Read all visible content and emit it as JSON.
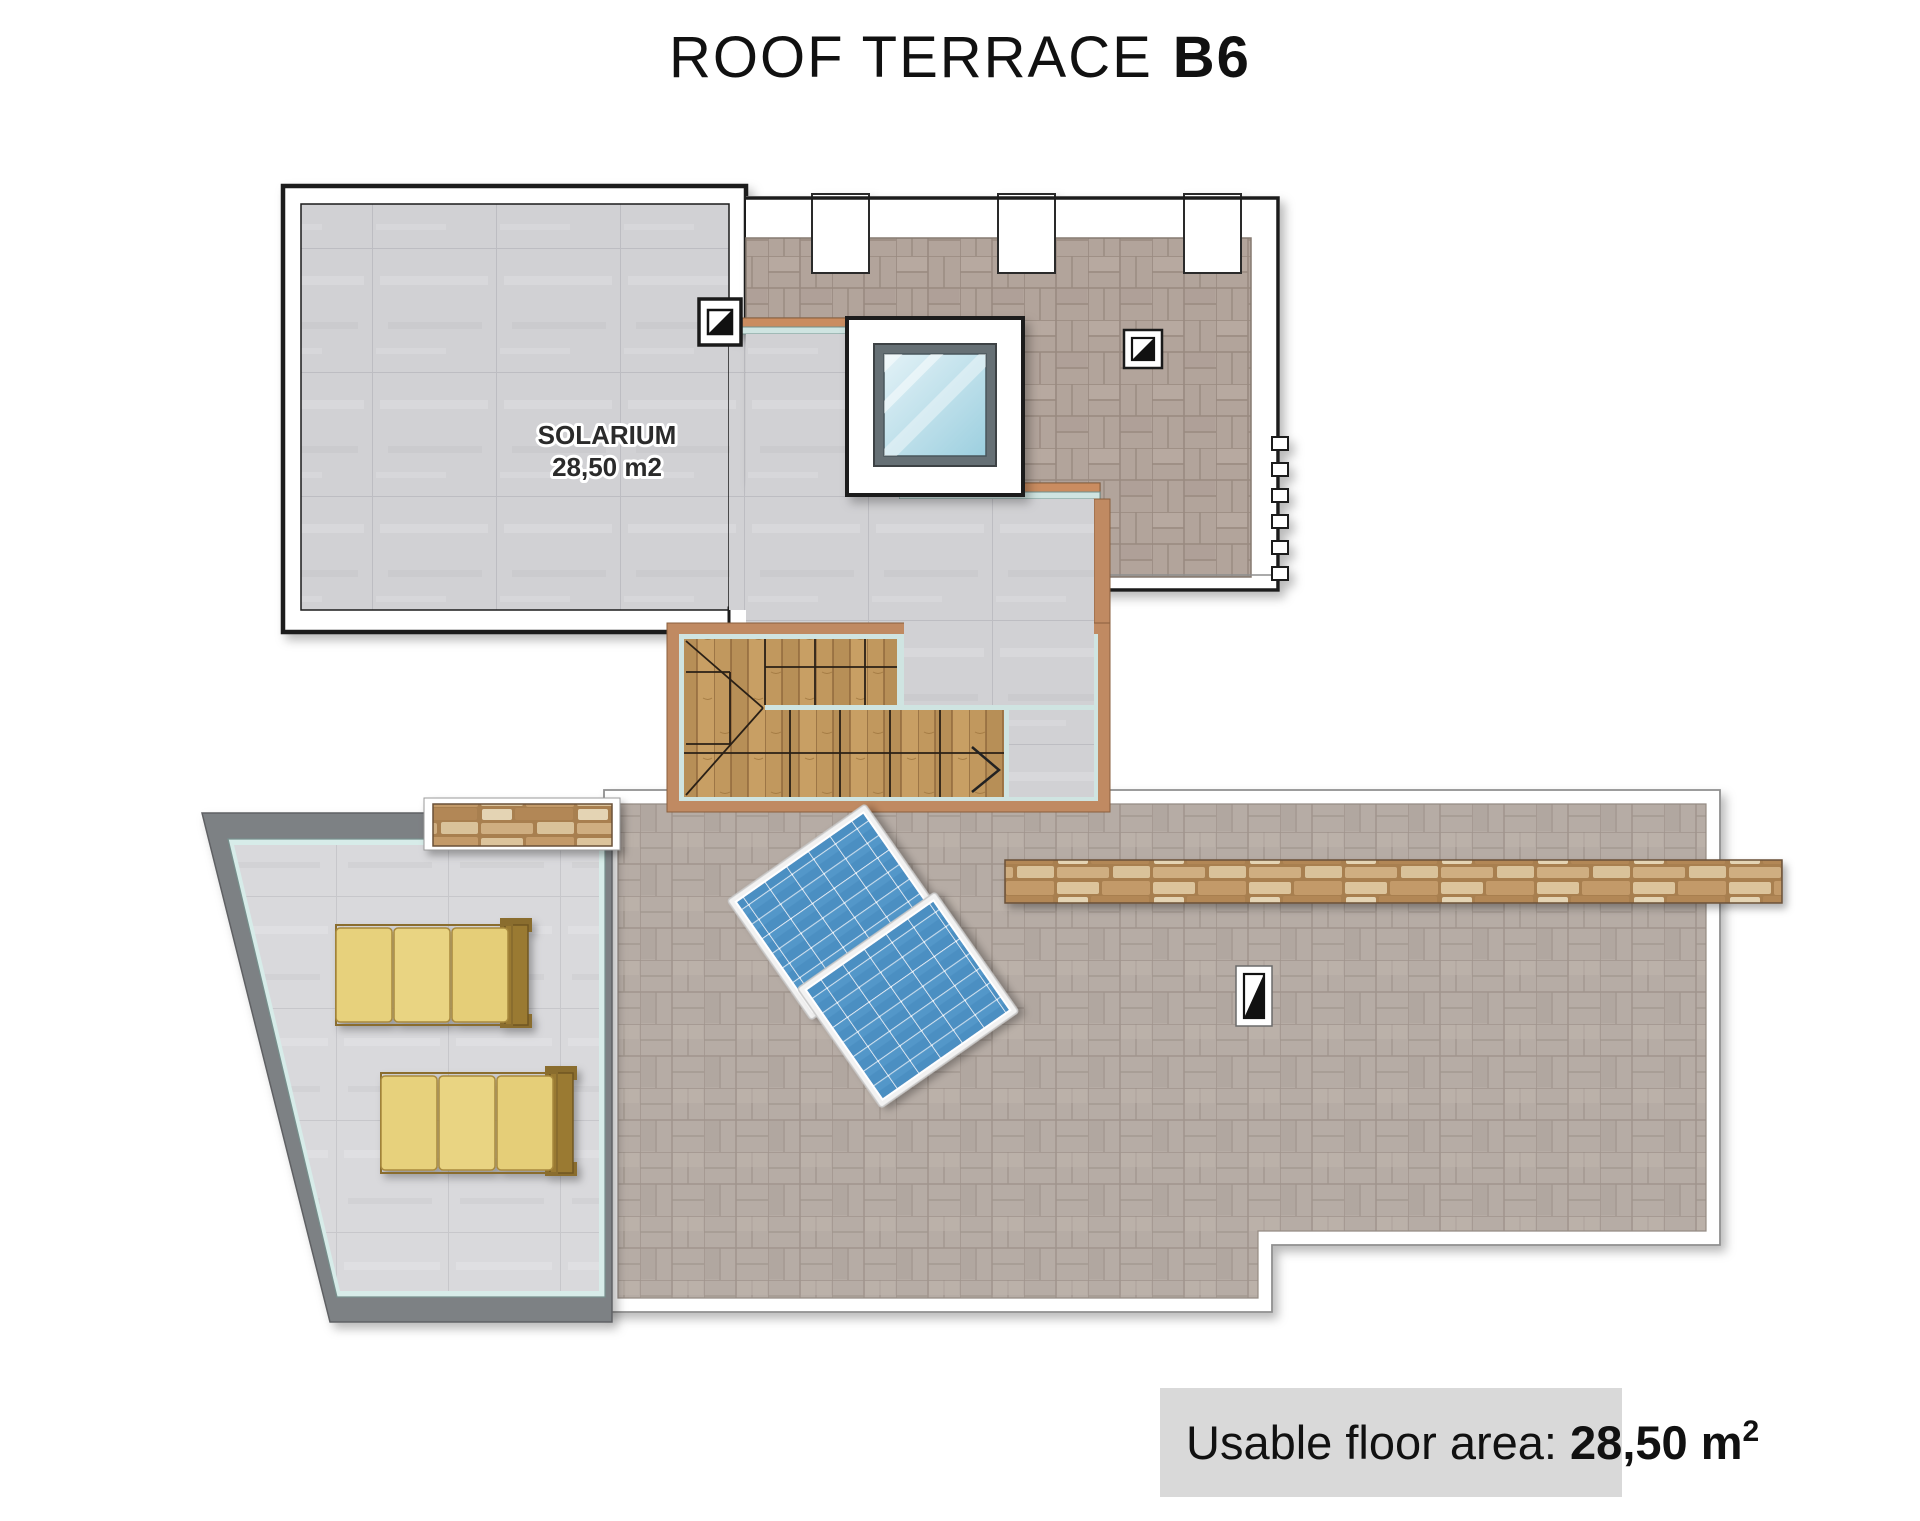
{
  "title": {
    "main": "ROOF TERRACE",
    "unit": "B6"
  },
  "rooms": {
    "solarium": {
      "name": "SOLARIUM",
      "area": "28,50 m2"
    }
  },
  "footer": {
    "label": "Usable floor area: ",
    "value": "28,50 m",
    "superscript": "2"
  },
  "features": {
    "skylight": "glass roof window",
    "stairs": "wooden winder staircase with direction arrow",
    "solar_panels": 2,
    "sun_loungers": 2,
    "drain_icons": 3,
    "stone_wall_strips": 2
  },
  "colors": {
    "solarium_tile": "#d1d1d4",
    "trapezoid_tile": "#d9d9dc",
    "upper_terrace_paver": "#b2a49b",
    "lower_terrace_paver": "#b6aca5",
    "wood": "#c1985e",
    "tan_curb": "#c08a62",
    "teal_glass_line": "#cfe4e1",
    "panel_blue": "#4b8fc2",
    "lounger_yellow": "#e7d17c",
    "stone": "#c9a878",
    "trapezoid_border": "#7d8184",
    "footer_bg": "#d9d9d9",
    "wall_outline": "#1a1a1a"
  }
}
